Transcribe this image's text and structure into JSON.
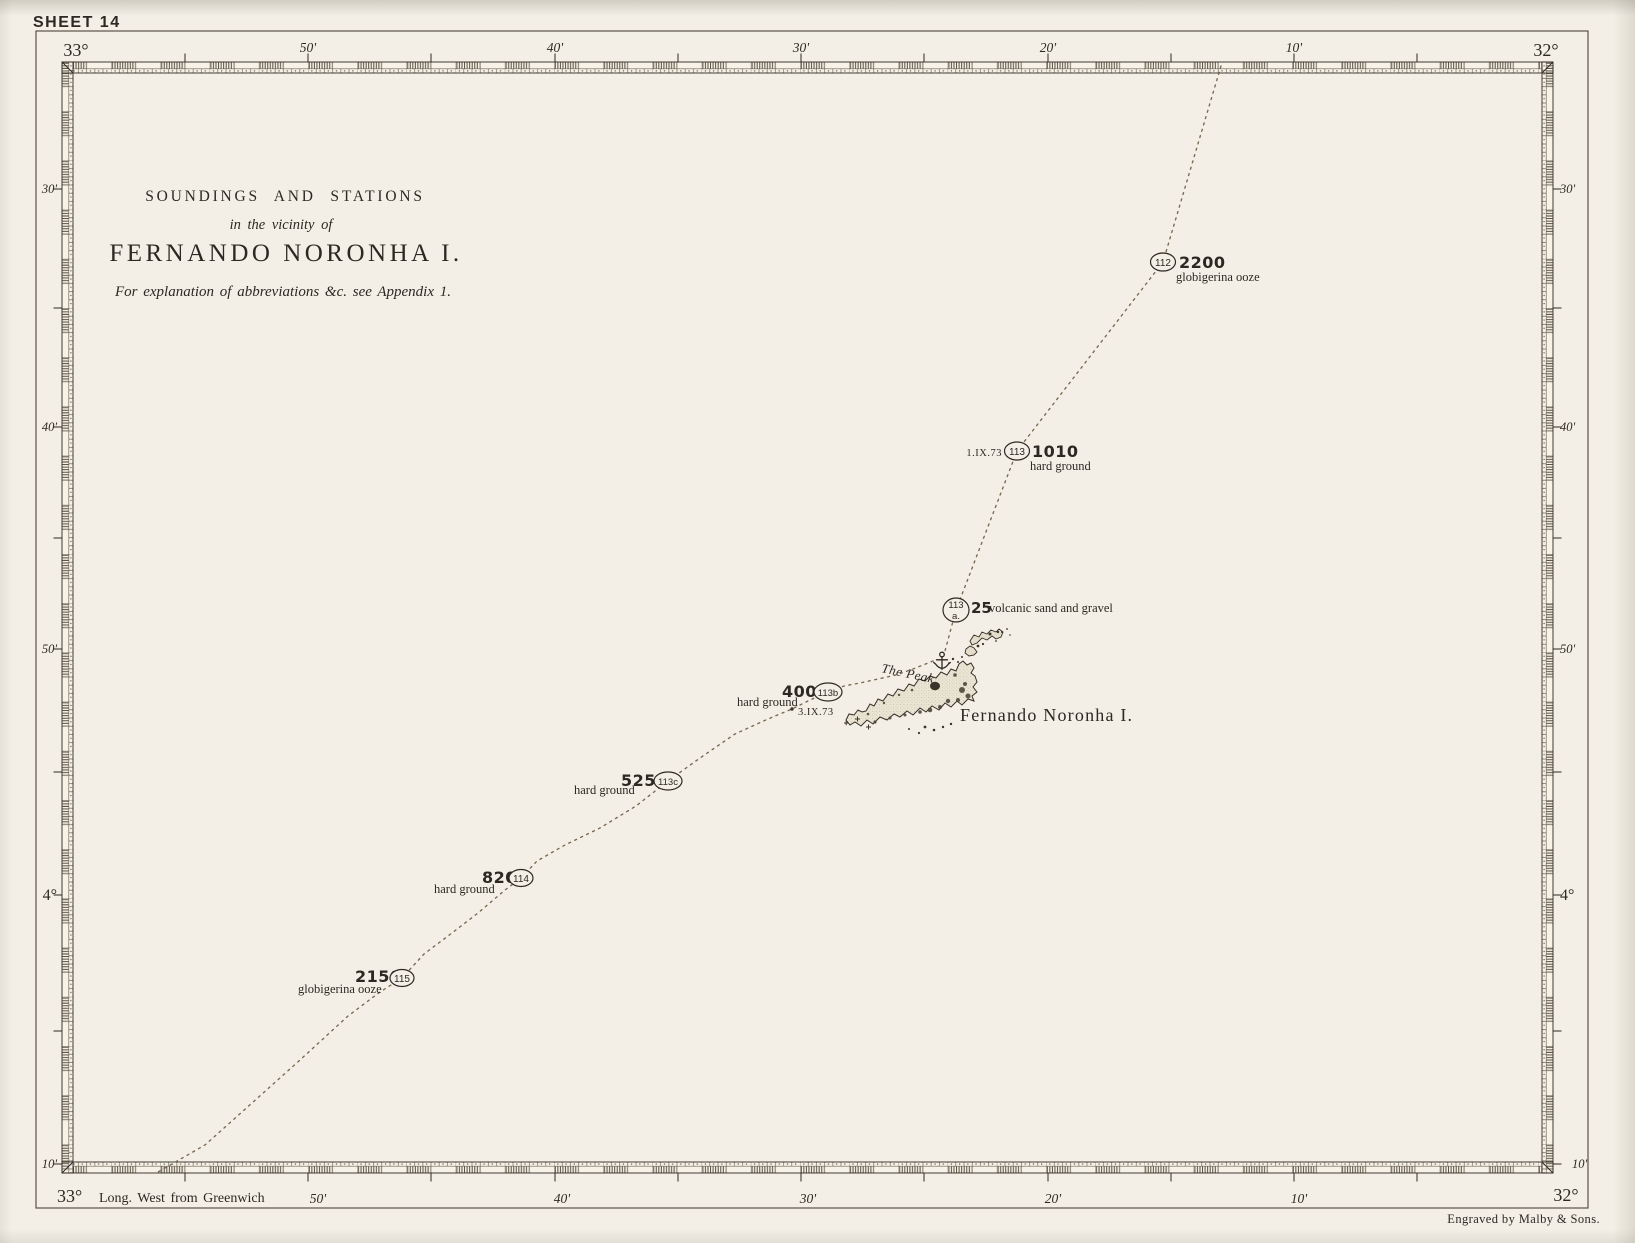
{
  "page": {
    "sheet_label": "SHEET 14",
    "credit": "Engraved by Malby & Sons.",
    "greenwich_note": "Long. West from Greenwich"
  },
  "title_block": {
    "line1": "SOUNDINGS AND STATIONS",
    "line2": "in the vicinity of",
    "line3": "FERNANDO NORONHA I.",
    "line4": "For explanation of abbreviations &c. see Appendix 1."
  },
  "scale_labels": {
    "top": [
      "33°",
      "50'",
      "40'",
      "30'",
      "20'",
      "10'",
      "32°"
    ],
    "bottom": [
      "33°",
      "50'",
      "40'",
      "30'",
      "20'",
      "10'",
      "32°"
    ],
    "left": [
      "30'",
      "40'",
      "50'",
      "4°",
      "10'"
    ],
    "right": [
      "30'",
      "40'",
      "50'",
      "4°",
      "10'"
    ]
  },
  "island": {
    "name": "Fernando Noronha I.",
    "peak_label": "The Peak"
  },
  "stations": [
    {
      "id": "112",
      "depth": "2200",
      "seabed": "globigerina ooze"
    },
    {
      "id": "113",
      "date": "1.IX.73",
      "depth": "1010",
      "seabed": "hard ground"
    },
    {
      "id": "113",
      "suffix": "a.",
      "depth": "25",
      "seabed": "volcanic sand and gravel"
    },
    {
      "id": "113b",
      "depth": "400",
      "seabed": "hard ground",
      "date": "3.IX.73"
    },
    {
      "id": "113c",
      "depth": "525",
      "seabed": "hard ground"
    },
    {
      "id": "114",
      "depth": "820",
      "seabed": "hard ground"
    },
    {
      "id": "115",
      "depth": "2150",
      "seabed": "globigerina ooze"
    }
  ],
  "colors": {
    "paper": "#f3efe6",
    "ink": "#2d2822",
    "track": "#77684f",
    "band_hatch": "#574e3d"
  }
}
